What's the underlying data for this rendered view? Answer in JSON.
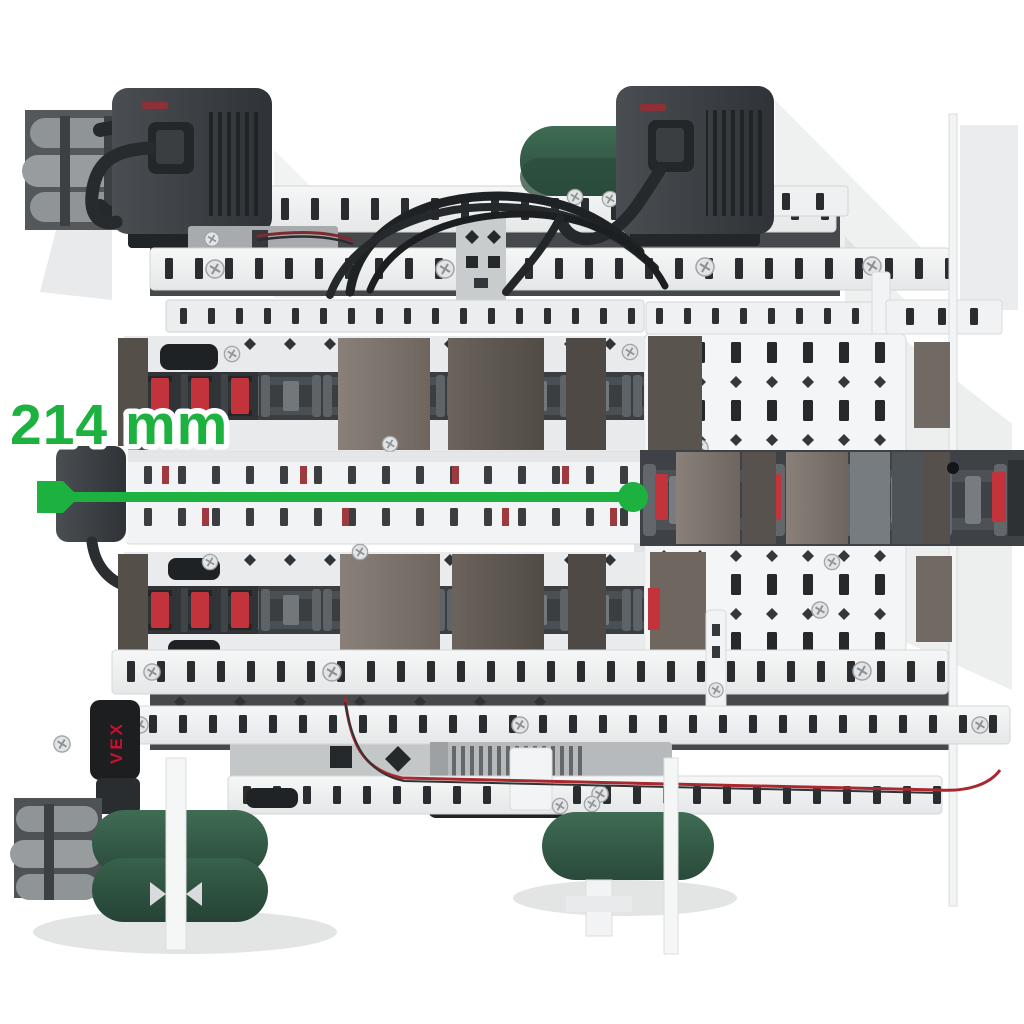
{
  "annotation": {
    "measurement_label": "214 mm",
    "measurement_value": "214",
    "measurement_unit": "mm",
    "accent_color": "#1DB13F"
  },
  "branding": {
    "chassis_logo": "VEX",
    "logo_color": "#C8102E"
  },
  "palette": {
    "background": "#FFFFFF",
    "structure_white": "#F1F2F3",
    "motor_housing_dark": "#3A3E42",
    "wheel_green": "#36604C",
    "omni_roller_gray": "#8F9496",
    "chain_link_red": "#C2333B",
    "tread_panel_taupe": "#7B7169"
  }
}
